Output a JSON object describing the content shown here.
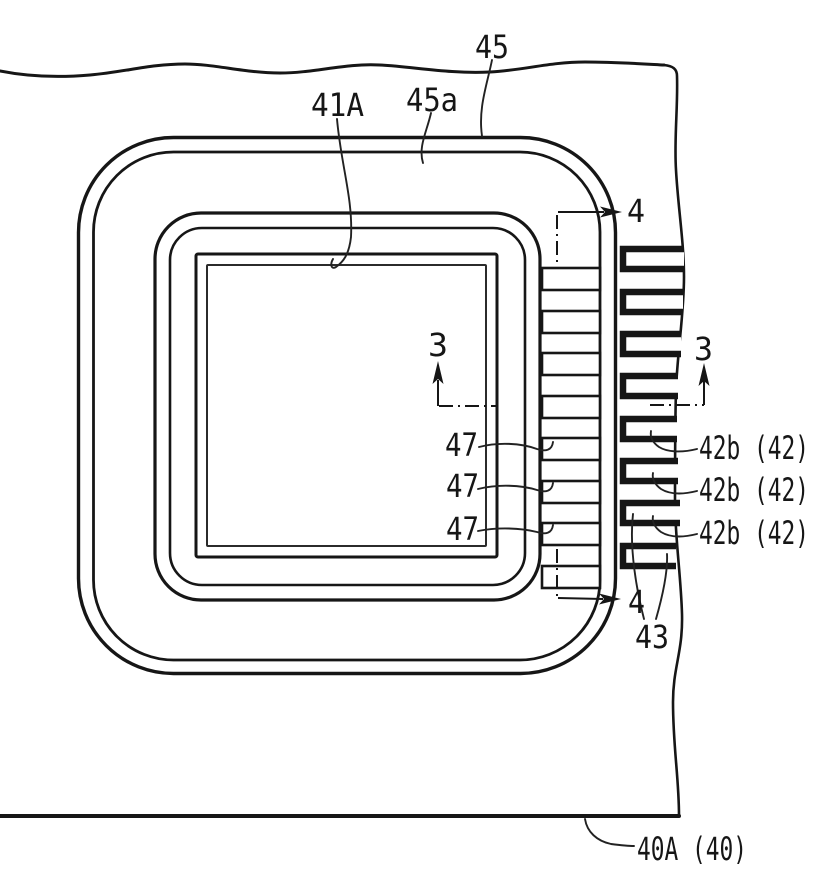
{
  "figure": {
    "title": "patent lead-frame package plan view",
    "colors": {
      "ink": "#161616",
      "background": "#ffffff"
    },
    "labels": [
      {
        "id": "45",
        "text": "45",
        "x": 475,
        "y": 58,
        "w": 34,
        "leader": "M492,60 C487,85 478,108 482,136"
      },
      {
        "id": "45a",
        "text": "45a",
        "x": 406,
        "y": 111,
        "w": 52,
        "leader": "M431,113 C427,131 418,147 423,163"
      },
      {
        "id": "41A",
        "text": "41A",
        "x": 311,
        "y": 116,
        "w": 53,
        "leader": "M337,119 C341,165 353,198 351,237 C349,255 343,262 336,267 C331,270 330,264 333,259"
      },
      {
        "id": "4-top",
        "text": "4",
        "x": 627,
        "y": 222,
        "w": 18,
        "leader": ""
      },
      {
        "id": "3-left",
        "text": "3",
        "x": 428,
        "y": 356,
        "w": 20,
        "leader": ""
      },
      {
        "id": "3-right",
        "text": "3",
        "x": 694,
        "y": 360,
        "w": 19,
        "leader": ""
      },
      {
        "id": "47-1",
        "text": "47",
        "x": 445,
        "y": 456,
        "w": 33,
        "leader": "M479,447 C498,442 521,443 537,449 C546,452 552,450 553,442"
      },
      {
        "id": "47-2",
        "text": "47",
        "x": 446,
        "y": 497,
        "w": 33,
        "leader": "M478,489 C498,484 521,485 537,490 C546,493 552,491 553,483"
      },
      {
        "id": "47-3",
        "text": "47",
        "x": 446,
        "y": 540,
        "w": 33,
        "leader": "M478,531 C498,527 521,528 537,532 C546,535 552,533 553,525"
      },
      {
        "id": "42b-1",
        "text": "42b (42)",
        "x": 699,
        "y": 459,
        "w": 110,
        "leader": "M697,449 C681,453 667,452 659,447 C652,442 650,437 651,431"
      },
      {
        "id": "42b-2",
        "text": "42b (42)",
        "x": 699,
        "y": 501,
        "w": 110,
        "leader": "M697,491 C681,495 669,494 661,489 C654,484 652,478 653,473"
      },
      {
        "id": "42b-3",
        "text": "42b (42)",
        "x": 699,
        "y": 544,
        "w": 110,
        "leader": "M697,534 C681,538 669,537 661,532 C654,527 652,521 653,516"
      },
      {
        "id": "4-bottom",
        "text": "4",
        "x": 628,
        "y": 613,
        "w": 17,
        "leader": ""
      },
      {
        "id": "43",
        "text": "43",
        "x": 635,
        "y": 648,
        "w": 34,
        "leader": "M644,619 C637,592 629,549 633,514 M656,619 C662,598 668,573 667,554"
      },
      {
        "id": "40A",
        "text": "40A (40)",
        "x": 637,
        "y": 860,
        "w": 110,
        "leader": "M585,819 C587,832 597,841 611,844 C619,845 627,846 634,846"
      }
    ],
    "leads": {
      "inner_bar_tops": [
        268,
        311,
        353,
        396,
        438,
        481,
        523,
        566
      ],
      "inner_bar_x": 542,
      "inner_bar_width": 58,
      "inner_bar_height": 22,
      "outer_bars": [
        {
          "t": 246,
          "r": 684
        },
        {
          "t": 289,
          "r": 683
        },
        {
          "t": 331,
          "r": 681
        },
        {
          "t": 373,
          "r": 678
        },
        {
          "t": 416,
          "r": 677
        },
        {
          "t": 458,
          "r": 678
        },
        {
          "t": 500,
          "r": 680
        },
        {
          "t": 543,
          "r": 676
        }
      ],
      "outer_bar_left_x": 623
    }
  }
}
